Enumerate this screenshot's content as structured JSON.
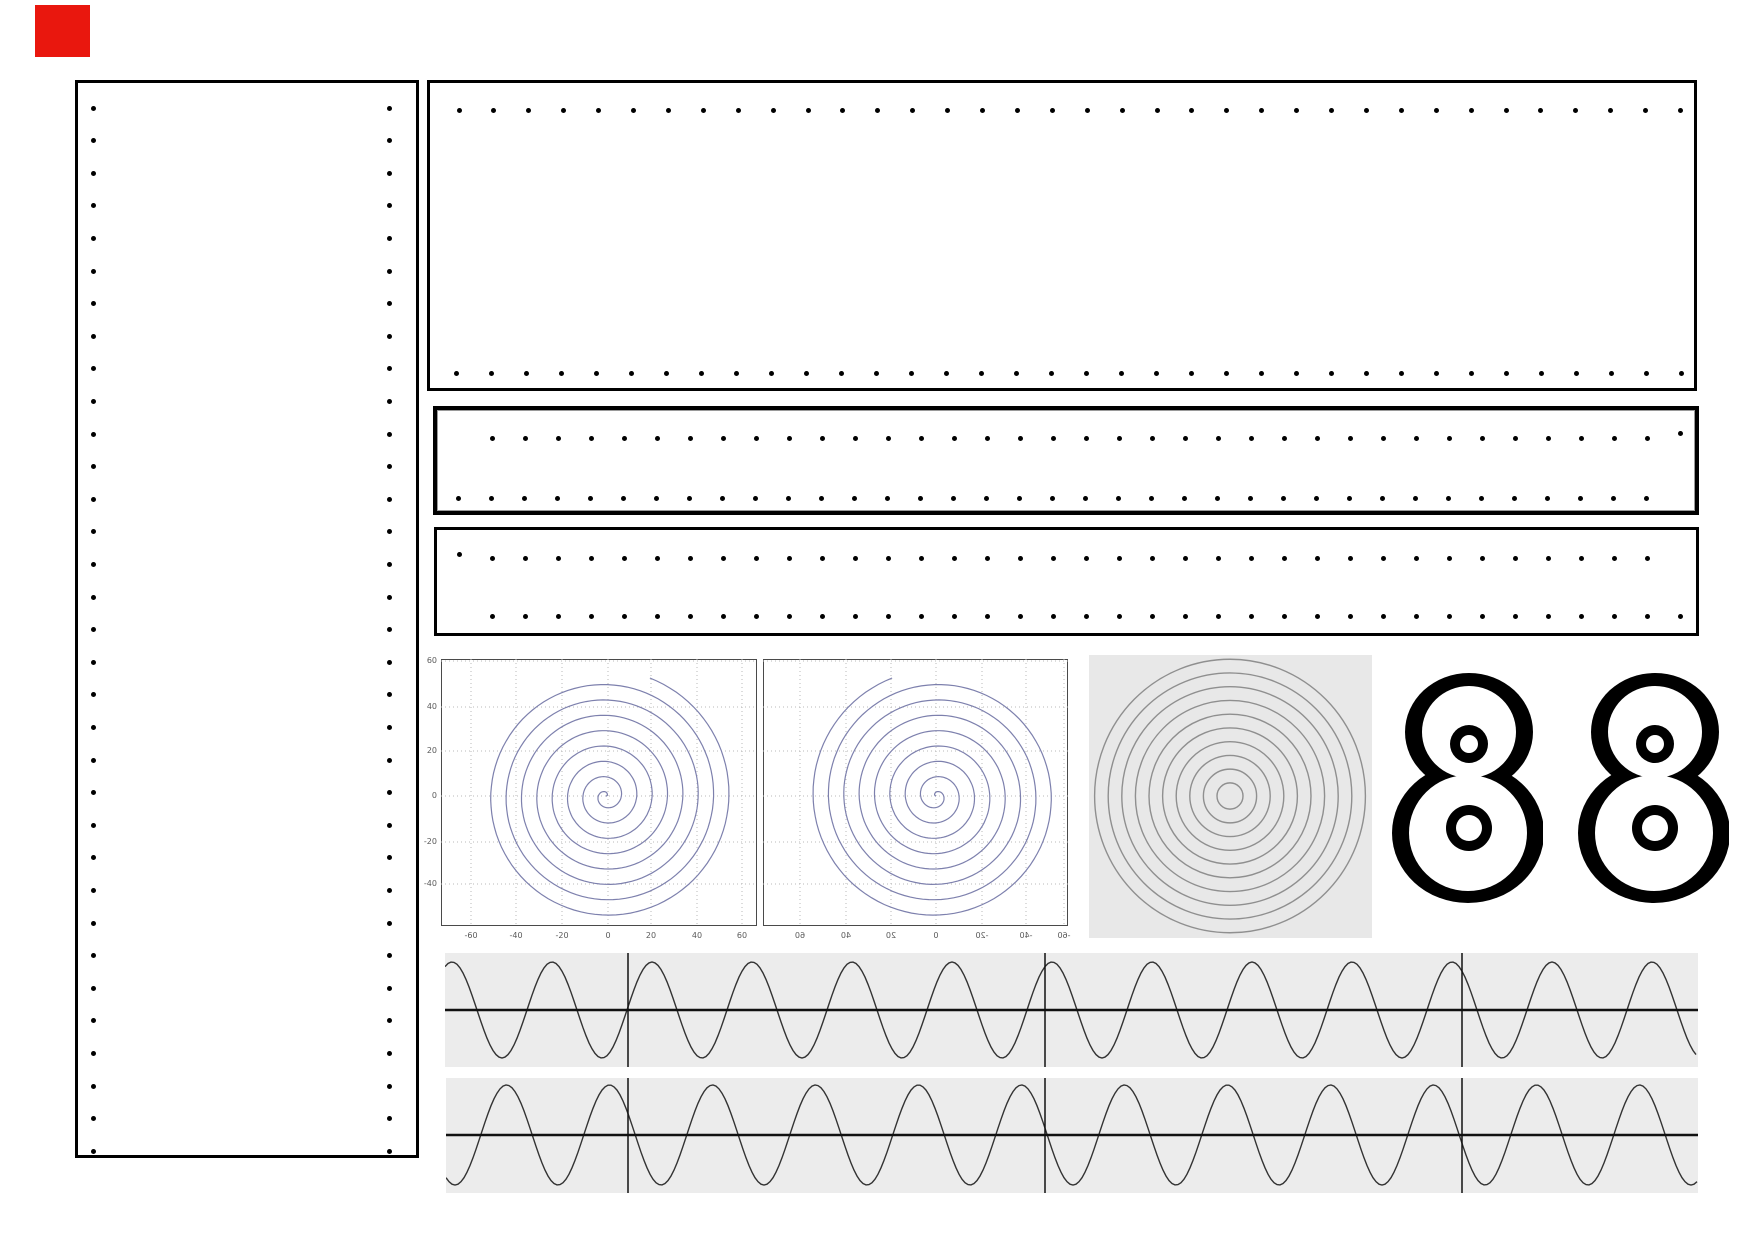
{
  "page": {
    "width": 1754,
    "height": 1240,
    "background": "#ffffff"
  },
  "red_marker": {
    "x": 35,
    "y": 5,
    "w": 55,
    "h": 52,
    "color": "#e9170e"
  },
  "dot_style": {
    "diameter": 5,
    "color": "#000000"
  },
  "panels": {
    "left": {
      "x": 75,
      "y": 80,
      "w": 344,
      "h": 1078
    },
    "top": {
      "x": 427,
      "y": 80,
      "w": 1270,
      "h": 311
    },
    "middle": {
      "x": 433,
      "y": 406,
      "w": 1266,
      "h": 109
    },
    "bottom": {
      "x": 434,
      "y": 527,
      "w": 1265,
      "h": 109
    }
  },
  "dot_rows": [
    {
      "x0": 459,
      "y": 110,
      "n": 36,
      "dx": 34.9
    },
    {
      "x0": 456,
      "y": 373,
      "n": 36,
      "dx": 35
    },
    {
      "x0": 492,
      "y": 438,
      "n": 36,
      "dx": 33
    },
    {
      "x0": 458,
      "y": 498,
      "n": 37,
      "dx": 33
    },
    {
      "x0": 492,
      "y": 558,
      "n": 36,
      "dx": 33
    },
    {
      "x0": 492,
      "y": 616,
      "n": 37,
      "dx": 33
    }
  ],
  "dot_cols": [
    {
      "x": 93,
      "y0": 108,
      "n": 33,
      "dy": 32.6
    },
    {
      "x": 389,
      "y0": 108,
      "n": 33,
      "dy": 32.6
    }
  ],
  "extra_dots": [
    {
      "x": 1680,
      "y": 433
    },
    {
      "x": 459,
      "y": 554
    }
  ],
  "plots": {
    "frame_color": "#4a4a4a",
    "grid_color": "#b8b8b8",
    "spiral_color": "#7d80ad",
    "left": {
      "x": 441,
      "y": 659,
      "w": 316,
      "h": 267,
      "cx": 606,
      "cy": 796,
      "x_ticks": [
        {
          "label": "-60",
          "px": 471
        },
        {
          "label": "-40",
          "px": 516
        },
        {
          "label": "-20",
          "px": 562
        },
        {
          "label": "0",
          "px": 608
        },
        {
          "label": "20",
          "px": 651
        },
        {
          "label": "40",
          "px": 697
        },
        {
          "label": "60",
          "px": 742
        }
      ],
      "y_ticks": [
        {
          "label": "60",
          "py": 661
        },
        {
          "label": "40",
          "py": 707
        },
        {
          "label": "20",
          "py": 751
        },
        {
          "label": "0",
          "py": 796
        },
        {
          "label": "-20",
          "py": 842
        },
        {
          "label": "-40",
          "py": 884
        }
      ],
      "label_row_y": 932,
      "ylabel_right_x": 437,
      "spiral": {
        "rmax": 126,
        "turns": 8.2,
        "dir": 1
      }
    },
    "right": {
      "x": 763,
      "y": 659,
      "w": 305,
      "h": 267,
      "cx": 936,
      "cy": 796,
      "x_ticks": [
        {
          "label": "60",
          "px": 800
        },
        {
          "label": "40",
          "px": 846
        },
        {
          "label": "20",
          "px": 891
        },
        {
          "label": "0",
          "px": 936
        },
        {
          "label": "-20",
          "px": 982
        },
        {
          "label": "-40",
          "px": 1026
        },
        {
          "label": "-60",
          "px": 1064
        }
      ],
      "y_ticks": [],
      "grid_y": [
        661,
        707,
        751,
        796,
        842,
        884
      ],
      "label_row_y": 932,
      "mirrored_labels": true,
      "spiral": {
        "rmax": 126,
        "turns": 8.2,
        "dir": -1
      }
    }
  },
  "rings_panel": {
    "x": 1089,
    "y": 655,
    "w": 283,
    "h": 283,
    "bg": "#e8e8e8",
    "cx": 1230,
    "cy": 796,
    "r0": 13,
    "dr": 13.6,
    "count": 10,
    "stroke": "#8f8f8f"
  },
  "digits": {
    "color": "#000000",
    "positions": [
      {
        "x": 1392,
        "y": 673
      },
      {
        "x": 1578,
        "y": 673
      }
    ],
    "w": 151,
    "h": 230,
    "top_outer": {
      "cx": 77,
      "cy": 59,
      "rx": 64,
      "ry": 59
    },
    "bot_outer": {
      "cx": 76,
      "cy": 160,
      "rx": 76,
      "ry": 70
    },
    "top_inner": {
      "cx": 77,
      "cy": 59,
      "rx": 47,
      "ry": 46
    },
    "bot_inner": {
      "cx": 76,
      "cy": 160,
      "rx": 59,
      "ry": 58
    },
    "hole_top": {
      "cx": 77,
      "cy": 71,
      "r": 19,
      "ir": 9
    },
    "hole_bot": {
      "cx": 77,
      "cy": 155,
      "r": 23,
      "ir": 13
    }
  },
  "waves": {
    "bg": "#ececec",
    "stroke": "#333333",
    "axis_color": "#111111",
    "dividers": [
      628,
      1045,
      1462
    ],
    "rows": [
      {
        "x": 445,
        "y": 953,
        "w": 1253,
        "h": 114,
        "mid": 1010,
        "amp": 48,
        "period": 100,
        "ref_x": 452,
        "ref_type": "peak"
      },
      {
        "x": 446,
        "y": 1078,
        "w": 1252,
        "h": 115,
        "mid": 1135,
        "amp": 50,
        "period": 103,
        "ref_x": 455,
        "ref_type": "trough"
      }
    ]
  }
}
